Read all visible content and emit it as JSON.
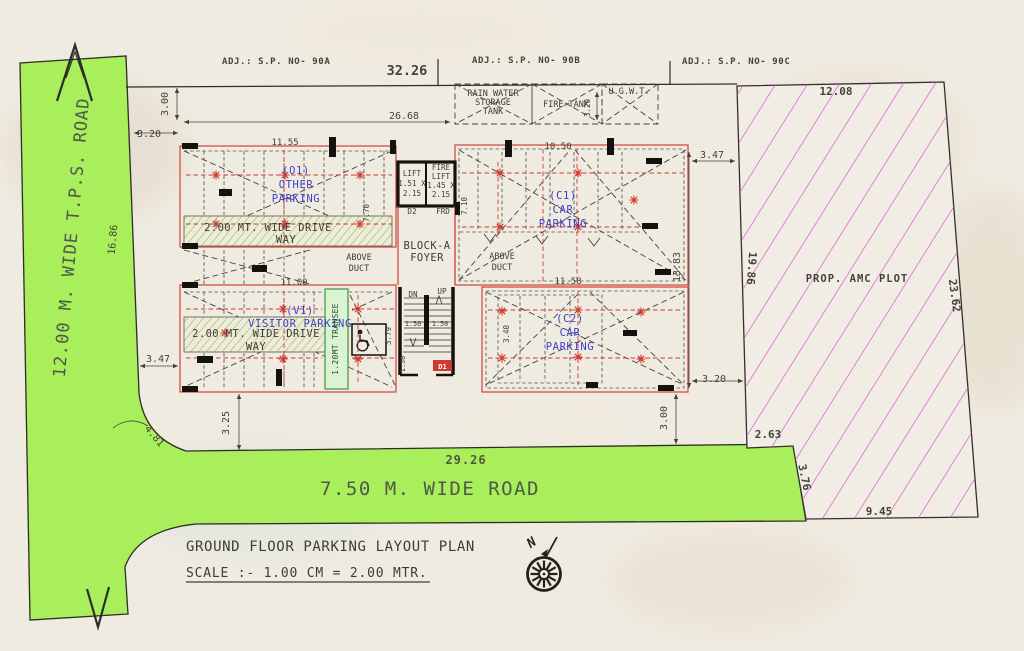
{
  "colors": {
    "bg": "#f0ebe1",
    "dim": "#45423c",
    "ink2": "#3f3c36",
    "blue": "#3e3ec8",
    "red": "#cf3a30",
    "roadgreen": "#a9ee5b",
    "roadtext": "#50584a",
    "magenta": "#cf4ccf",
    "stripgreen": "#3fae43",
    "drivefill": "#ecedd5",
    "stripfill": "#dbf3d2"
  },
  "sheet": {
    "title": "GROUND FLOOR PARKING LAYOUT PLAN",
    "scale": "SCALE :- 1.00 CM = 2.00 MTR.",
    "north": "N"
  },
  "roads": {
    "left": "12.00 M. WIDE T.P.S. ROAD",
    "bottom": "7.50 M. WIDE ROAD"
  },
  "adjacent_plots": {
    "a": "ADJ.: S.P. NO- 90A",
    "b": "ADJ.: S.P. NO- 90B",
    "c": "ADJ.: S.P. NO- 90C"
  },
  "amc_plot": {
    "label": "PROP. AMC PLOT"
  },
  "tanks": {
    "rain_l1": "RAIN WATER",
    "rain_l2": "STORAGE",
    "rain_l3": "TANK",
    "fire": "FIRE TANK",
    "ugwt": "U.G.W.T."
  },
  "parking": {
    "o1_l1": "(O1)",
    "o1_l2": "OTHER",
    "o1_l3": "PARKING",
    "c1_l1": "(C1)",
    "c1_l2": "CAR",
    "c1_l3": "PARKING",
    "v1_l1": "(V1)",
    "v1_l2": "VISITOR PARKING",
    "c2_l1": "(C2)",
    "c2_l2": "CAR",
    "c2_l3": "PARKING",
    "drive_way_1_l1": "2.00 MT. WIDE DRIVE",
    "drive_way_1_l2": "WAY",
    "drive_way_2_l1": "2.00 MT. WIDE DRIVE",
    "drive_way_2_l2": "WAY",
    "transfer_strip": "1.20MT TRANSEE"
  },
  "core": {
    "lift1_l1": "LIFT",
    "lift1_l2": "1.51 X",
    "lift1_l3": "2.15",
    "lift2_l1": "FIRE",
    "lift2_l2": "LIFT",
    "lift2_l3": "1.45 X",
    "lift2_l4": "2.15",
    "door_d2": "D2",
    "door_frd": "FRD",
    "door_d1": "D1",
    "foyer_l1": "BLOCK-A",
    "foyer_l2": "FOYER",
    "stair_down": "DN",
    "stair_up": "UP",
    "duct1_l1": "ABOVE",
    "duct1_l2": "DUCT",
    "duct2_l1": "ABOVE",
    "duct2_l2": "DUCT"
  },
  "dims": {
    "boundary_top": "32.26",
    "inner_top": "26.68",
    "left_top": "3.00",
    "left_upper": "3.20",
    "o1_width": "11.55",
    "c1_width": "10.50",
    "right_gap_top": "3.47",
    "right_height": "13.83",
    "core_left": "7.70",
    "core_right": "7.10",
    "ugwt_width": "3.20",
    "v1_width": "11.00",
    "c2_width": "11.58",
    "right_gap_bottom": "3.20",
    "right_lower": "3.00",
    "left_lower": "3.47",
    "left_bottom": "3.25",
    "road_left_length": "16.86",
    "corner_radius": "4.81",
    "road_bottom_length": "29.26",
    "plot_top": "12.08",
    "plot_left": "19.86",
    "plot_right": "23.62",
    "plot_step": "2.63",
    "plot_slant": "3.76",
    "plot_bottom": "9.45",
    "stair_flight_left": "1.50",
    "stair_flight_right": "1.50",
    "stair_exit": "1.50",
    "lobby_width": "3.79",
    "stair_depth": "3.40"
  }
}
